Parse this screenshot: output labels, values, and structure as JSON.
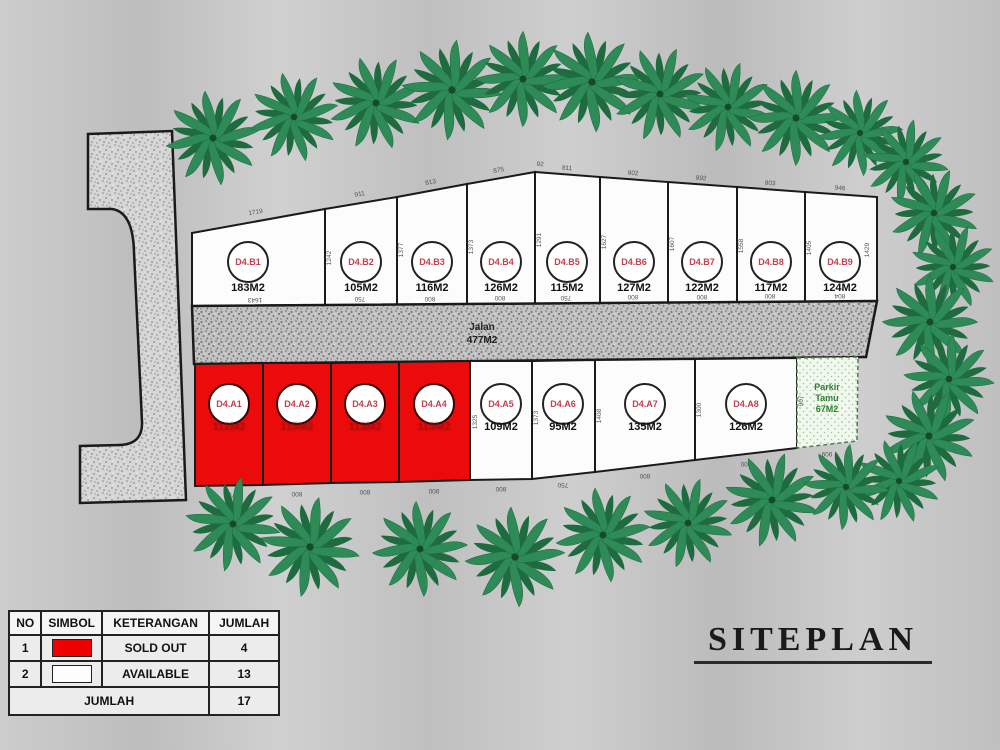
{
  "title": {
    "text": "SITEPLAN"
  },
  "legend": {
    "headers": [
      "NO",
      "SIMBOL",
      "KETERANGAN",
      "JUMLAH"
    ],
    "rows": [
      {
        "no": "1",
        "keterangan": "SOLD OUT",
        "jumlah": "4",
        "symbol_color": "#ee0000"
      },
      {
        "no": "2",
        "keterangan": "AVAILABLE",
        "jumlah": "13",
        "symbol_color": "#ffffff"
      }
    ],
    "footer": {
      "label": "JUMLAH",
      "value": "17"
    }
  },
  "site": {
    "road": {
      "label": "Jalan",
      "area": "477M2"
    },
    "parking": {
      "label": "Parkir Tamu",
      "line1": "Parkir",
      "line2": "Tamu",
      "area": "67M2"
    },
    "plots_row_b": [
      {
        "id": "D4.B1",
        "area": "183M2",
        "status": "available"
      },
      {
        "id": "D4.B2",
        "area": "105M2",
        "status": "available"
      },
      {
        "id": "D4.B3",
        "area": "116M2",
        "status": "available"
      },
      {
        "id": "D4.B4",
        "area": "126M2",
        "status": "available"
      },
      {
        "id": "D4.B5",
        "area": "115M2",
        "status": "available"
      },
      {
        "id": "D4.B6",
        "area": "127M2",
        "status": "available"
      },
      {
        "id": "D4.B7",
        "area": "122M2",
        "status": "available"
      },
      {
        "id": "D4.B8",
        "area": "117M2",
        "status": "available"
      },
      {
        "id": "D4.B9",
        "area": "124M2",
        "status": "available"
      }
    ],
    "plots_row_a": [
      {
        "id": "D4.A1",
        "area": "112M2",
        "status": "sold"
      },
      {
        "id": "D4.A2",
        "area": "115M2",
        "status": "sold"
      },
      {
        "id": "D4.A3",
        "area": "113M2",
        "status": "sold"
      },
      {
        "id": "D4.A4",
        "area": "113M2",
        "status": "sold"
      },
      {
        "id": "D4.A5",
        "area": "109M2",
        "status": "available"
      },
      {
        "id": "D4.A6",
        "area": "95M2",
        "status": "available"
      },
      {
        "id": "D4.A7",
        "area": "135M2",
        "status": "available"
      },
      {
        "id": "D4.A8",
        "area": "126M2",
        "status": "available"
      }
    ],
    "dimensions": {
      "top": [
        {
          "t": "1719",
          "x": 256,
          "y": 214,
          "r": -10
        },
        {
          "t": "911",
          "x": 360,
          "y": 196,
          "r": -10
        },
        {
          "t": "813",
          "x": 431,
          "y": 184,
          "r": -10
        },
        {
          "t": "875",
          "x": 499,
          "y": 172,
          "r": -10
        },
        {
          "t": "92",
          "x": 540,
          "y": 166,
          "r": 4
        },
        {
          "t": "811",
          "x": 567,
          "y": 170,
          "r": 4
        },
        {
          "t": "802",
          "x": 633,
          "y": 175,
          "r": 4
        },
        {
          "t": "892",
          "x": 701,
          "y": 180,
          "r": 4
        },
        {
          "t": "803",
          "x": 770,
          "y": 185,
          "r": 4
        },
        {
          "t": "946",
          "x": 840,
          "y": 190,
          "r": 4
        }
      ],
      "row_b_bottom": [
        {
          "t": "1643",
          "x": 255,
          "y": 298,
          "r": 180
        },
        {
          "t": "750",
          "x": 360,
          "y": 297,
          "r": 180
        },
        {
          "t": "800",
          "x": 430,
          "y": 297,
          "r": 180
        },
        {
          "t": "800",
          "x": 500,
          "y": 296,
          "r": 180
        },
        {
          "t": "750",
          "x": 566,
          "y": 296,
          "r": 180
        },
        {
          "t": "800",
          "x": 633,
          "y": 295,
          "r": 180
        },
        {
          "t": "800",
          "x": 702,
          "y": 295,
          "r": 180
        },
        {
          "t": "800",
          "x": 770,
          "y": 294,
          "r": 180
        },
        {
          "t": "804",
          "x": 840,
          "y": 294,
          "r": 180
        }
      ],
      "row_b_side": [
        {
          "t": "1242",
          "x": 331,
          "y": 258,
          "r": -90
        },
        {
          "t": "1377",
          "x": 403,
          "y": 250,
          "r": -90
        },
        {
          "t": "1373",
          "x": 473,
          "y": 247,
          "r": -90
        },
        {
          "t": "1291",
          "x": 541,
          "y": 240,
          "r": -90
        },
        {
          "t": "1627",
          "x": 606,
          "y": 242,
          "r": -90
        },
        {
          "t": "1607",
          "x": 674,
          "y": 244,
          "r": -90
        },
        {
          "t": "1558",
          "x": 743,
          "y": 246,
          "r": -90
        },
        {
          "t": "1405",
          "x": 811,
          "y": 248,
          "r": -90
        },
        {
          "t": "1429",
          "x": 869,
          "y": 250,
          "r": -90
        }
      ],
      "row_a_bottom": [
        {
          "t": "750",
          "x": 230,
          "y": 493,
          "r": 180
        },
        {
          "t": "800",
          "x": 297,
          "y": 492,
          "r": 180
        },
        {
          "t": "800",
          "x": 365,
          "y": 490,
          "r": 180
        },
        {
          "t": "800",
          "x": 434,
          "y": 489,
          "r": 180
        },
        {
          "t": "800",
          "x": 501,
          "y": 487,
          "r": 180
        },
        {
          "t": "750",
          "x": 563,
          "y": 483,
          "r": 180
        },
        {
          "t": "800",
          "x": 645,
          "y": 474,
          "r": 180
        },
        {
          "t": "800",
          "x": 746,
          "y": 462,
          "r": 180
        },
        {
          "t": "909",
          "x": 827,
          "y": 452,
          "r": 180
        }
      ],
      "row_a_side": [
        {
          "t": "1325",
          "x": 477,
          "y": 422,
          "r": -90
        },
        {
          "t": "1373",
          "x": 538,
          "y": 418,
          "r": -90
        },
        {
          "t": "1408",
          "x": 601,
          "y": 416,
          "r": -90
        },
        {
          "t": "1300",
          "x": 701,
          "y": 410,
          "r": -90
        },
        {
          "t": "907",
          "x": 803,
          "y": 401,
          "r": -90
        }
      ]
    }
  },
  "trees": [
    {
      "x": 213,
      "y": 138,
      "s": 1.0,
      "r": 0
    },
    {
      "x": 294,
      "y": 117,
      "s": 0.95,
      "r": 40
    },
    {
      "x": 376,
      "y": 103,
      "s": 1.0,
      "r": 80
    },
    {
      "x": 452,
      "y": 90,
      "s": 1.05,
      "r": 15
    },
    {
      "x": 523,
      "y": 79,
      "s": 1.0,
      "r": 55
    },
    {
      "x": 592,
      "y": 82,
      "s": 1.05,
      "r": 95
    },
    {
      "x": 660,
      "y": 94,
      "s": 1.0,
      "r": 30
    },
    {
      "x": 728,
      "y": 107,
      "s": 0.95,
      "r": 70
    },
    {
      "x": 796,
      "y": 118,
      "s": 1.0,
      "r": 10
    },
    {
      "x": 860,
      "y": 133,
      "s": 0.9,
      "r": 50
    },
    {
      "x": 906,
      "y": 162,
      "s": 0.9,
      "r": 20
    },
    {
      "x": 934,
      "y": 213,
      "s": 0.95,
      "r": 30
    },
    {
      "x": 953,
      "y": 267,
      "s": 0.9,
      "r": 75
    },
    {
      "x": 930,
      "y": 322,
      "s": 1.0,
      "r": 10
    },
    {
      "x": 949,
      "y": 379,
      "s": 0.95,
      "r": 60
    },
    {
      "x": 929,
      "y": 436,
      "s": 1.0,
      "r": 35
    },
    {
      "x": 899,
      "y": 481,
      "s": 0.9,
      "r": 80
    },
    {
      "x": 233,
      "y": 524,
      "s": 1.0,
      "r": 20
    },
    {
      "x": 310,
      "y": 547,
      "s": 1.05,
      "r": 65
    },
    {
      "x": 420,
      "y": 549,
      "s": 1.0,
      "r": 5
    },
    {
      "x": 515,
      "y": 557,
      "s": 1.05,
      "r": 50
    },
    {
      "x": 603,
      "y": 535,
      "s": 1.0,
      "r": 90
    },
    {
      "x": 688,
      "y": 523,
      "s": 0.95,
      "r": 25
    },
    {
      "x": 772,
      "y": 500,
      "s": 1.0,
      "r": 70
    },
    {
      "x": 846,
      "y": 487,
      "s": 0.9,
      "r": 15
    }
  ],
  "colors": {
    "sold_red": "#ee0000",
    "available_white": "#fcfcfc",
    "plot_id_text": "#c2404f",
    "area_text": "#111111",
    "parking_text": "#2e7d32",
    "tree_green": "#2e8b57",
    "road_texture_base": "#c2c2c2"
  }
}
